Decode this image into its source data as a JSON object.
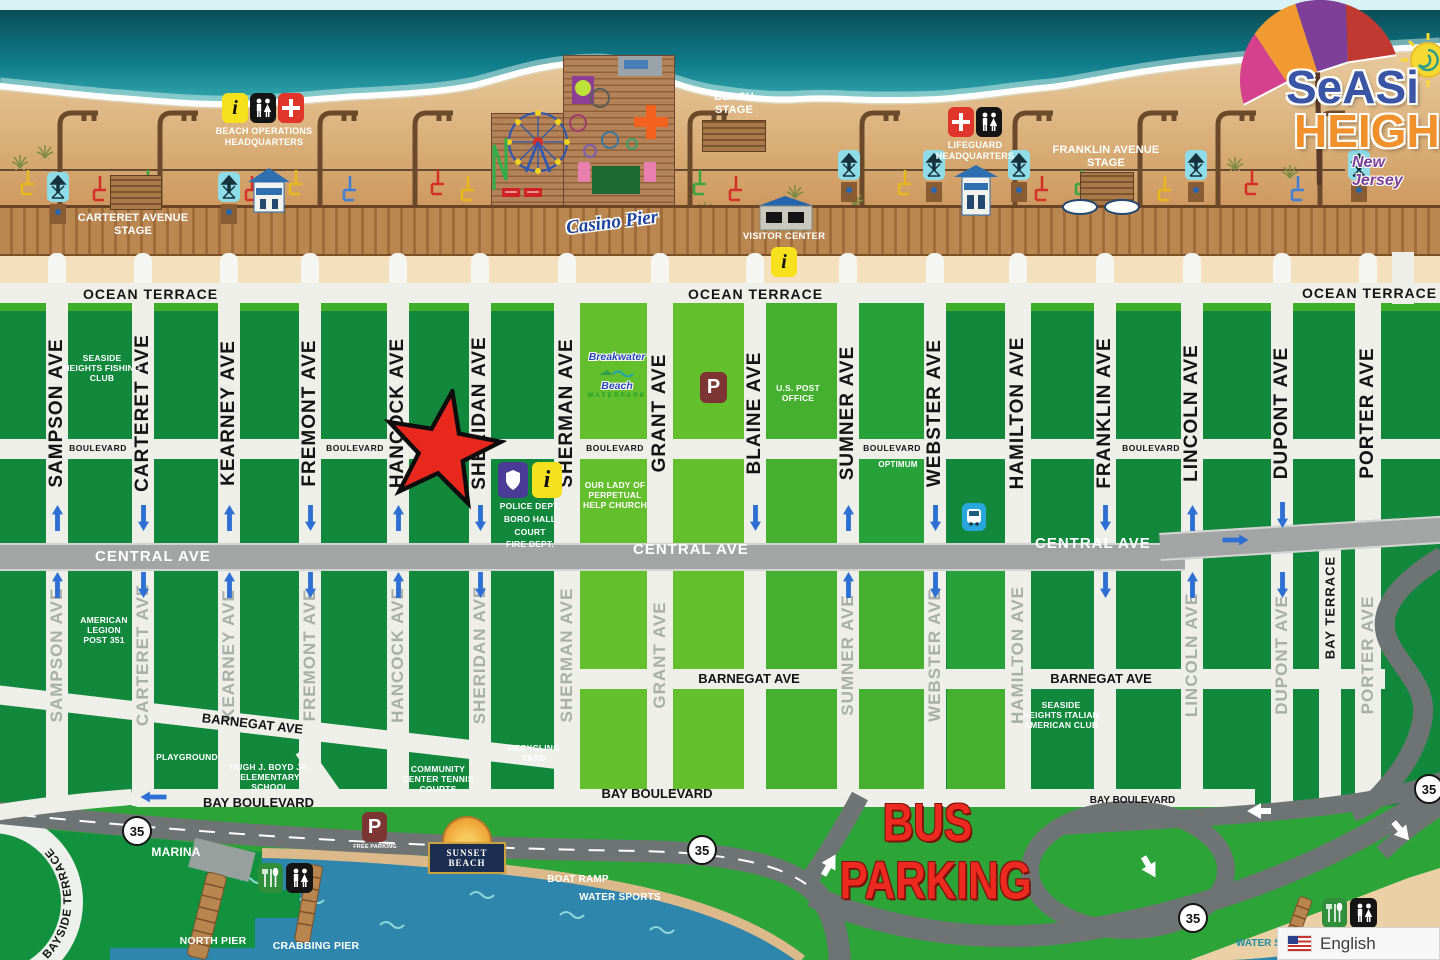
{
  "palette": {
    "accent_red": "#e8271d",
    "dark_green": "#11883c",
    "light_green": "#64bf2c",
    "ocean_teal": "#0f7b89",
    "bay_blue": "#2e86ad",
    "highway_gray": "#6e7473",
    "road_white": "#eeefe9",
    "bus_red": "#ed2a1f",
    "info_yellow": "#f6e11c"
  },
  "logo": {
    "line1": "SeASi",
    "line2": "HEIGH",
    "subtitle": "New Jersey"
  },
  "boardwalk": {
    "carteret_stage": "CARTERET AVENUE STAGE",
    "beach_operations_hq": "BEACH OPERATIONS HEADQUARTERS",
    "casino_pier": "Casino Pier",
    "beach_stage": "BEACH STAGE",
    "visitor_center": "VISITOR CENTER",
    "lifeguard_hq": "LIFEGUARD HEADQUARTERS",
    "franklin_stage": "FRANKLIN AVENUE STAGE"
  },
  "streets": {
    "ocean_terrace": "OCEAN TERRACE",
    "boulevard": "BOULEVARD",
    "central": "CENTRAL AVE",
    "barnegat": "BARNEGAT AVE",
    "bay_boulevard": "BAY BOULEVARD",
    "bay_terrace": "BAY TERRACE",
    "route_35": "35",
    "avenues": [
      "SAMPSON AVE",
      "CARTERET AVE",
      "KEARNEY AVE",
      "FREMONT AVE",
      "HANCOCK AVE",
      "SHERIDAN AVE",
      "SHERMAN AVE",
      "GRANT AVE",
      "BLAINE AVE",
      "SUMNER AVE",
      "WEBSTER AVE",
      "HAMILTON AVE",
      "FRANKLIN AVE",
      "LINCOLN AVE",
      "DUPONT AVE",
      "PORTER AVE"
    ]
  },
  "landmarks": {
    "fishing_club": "SEASIDE HEIGHTS FISHING CLUB",
    "post_office": "U.S. POST OFFICE",
    "church": "OUR LADY OF PERPETUAL HELP CHURCH",
    "optimum": "OPTIMUM",
    "police_lines": [
      "POLICE DEPT.",
      "BORO HALL",
      "COURT",
      "FIRE DEPT."
    ],
    "breakwater": {
      "line1": "Breakwater",
      "line2": "Beach",
      "line3": "WATERPARK"
    },
    "american_legion": "AMERICAN LEGION POST 351",
    "playground": "PLAYGROUND",
    "school": "HUGH J. BOYD JR. ELEMENTARY SCHOOL",
    "community_center": "COMMUNITY CENTER TENNIS COURTS",
    "recycling": "RECYCLING YARD",
    "italian_club": "SEASIDE HEIGHTS ITALIAN AMERICAN CLUB"
  },
  "bus_parking": {
    "line1": "BUS",
    "line2": "PARKING"
  },
  "bay": {
    "marina": "MARINA",
    "north_pier": "NORTH PIER",
    "crabbing_pier": "CRABBING PIER",
    "boat_ramp": "BOAT RAMP",
    "water_sports": "WATER SPORTS",
    "bayside_terrace": "BAYSIDE TERRACE",
    "sunset_beach": "SUNSET BEACH",
    "free_parking": "FREE PARKING",
    "water_partial": "WATER S"
  },
  "widget": {
    "language": "English"
  }
}
